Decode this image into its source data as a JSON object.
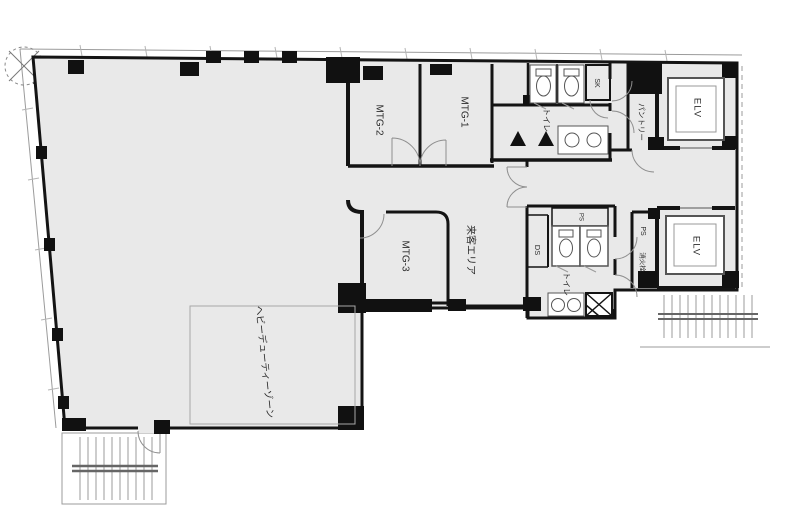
{
  "plan": {
    "colors": {
      "background": "#ffffff",
      "floor_fill": "#e9e9e9",
      "wall_color": "#141414",
      "thin_line": "#9b9b9b"
    },
    "rooms": {
      "mtg1": "MTG-1",
      "mtg2": "MTG-2",
      "mtg3": "MTG-3",
      "visitor_area": "来客エリア",
      "heavy_duty_zone": "ヘビーデューティーゾーン",
      "pantry": "パントリー",
      "toilet_upper": "トイレ",
      "toilet_lower": "トイレ",
      "elevator_upper": "ELV",
      "elevator_lower": "ELV",
      "sk_upper": "SK",
      "ds": "DS",
      "ps_shaft": "PS",
      "ps_fire": "PS",
      "fire_hydrant": "消火栓"
    }
  }
}
